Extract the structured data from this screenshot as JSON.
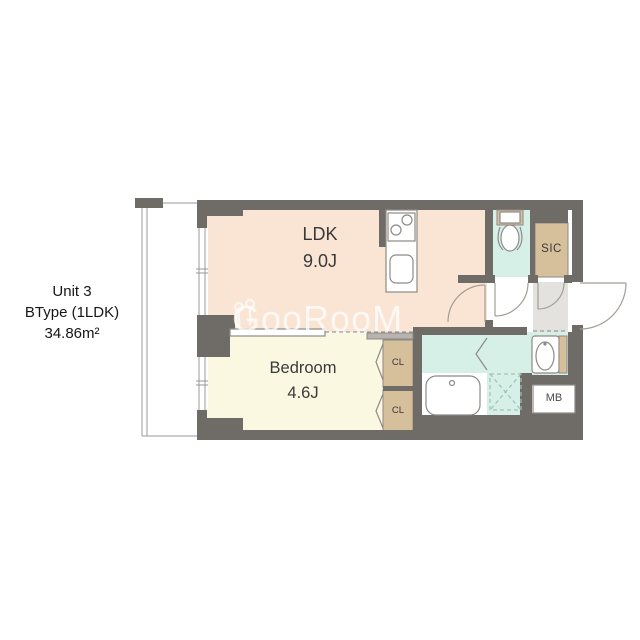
{
  "title_block": {
    "unit": "Unit 3",
    "type": "BType (1LDK)",
    "area": "34.86m²"
  },
  "rooms": {
    "ldk": {
      "name": "LDK",
      "size": "9.0J"
    },
    "bedroom": {
      "name": "Bedroom",
      "size": "4.6J"
    },
    "sic": {
      "label": "SIC"
    },
    "closet_upper": {
      "label": "CL"
    },
    "closet_lower": {
      "label": "CL"
    },
    "meter_box": {
      "label": "MB"
    }
  },
  "watermark": {
    "text": "GooRooM"
  },
  "colors": {
    "wall": "#6f6b67",
    "ldk": "#fae4d3",
    "bedroom": "#fbf8e2",
    "wet": "#d6f0e8",
    "storage": "#d6bf9b",
    "entrance": "#e4e2df",
    "fixture": "#8e8a86",
    "door": "#a39d95",
    "dashed": "#9cc4b6",
    "text": "#3a3a3a",
    "watermark": "rgba(255,255,255,0.75)"
  }
}
